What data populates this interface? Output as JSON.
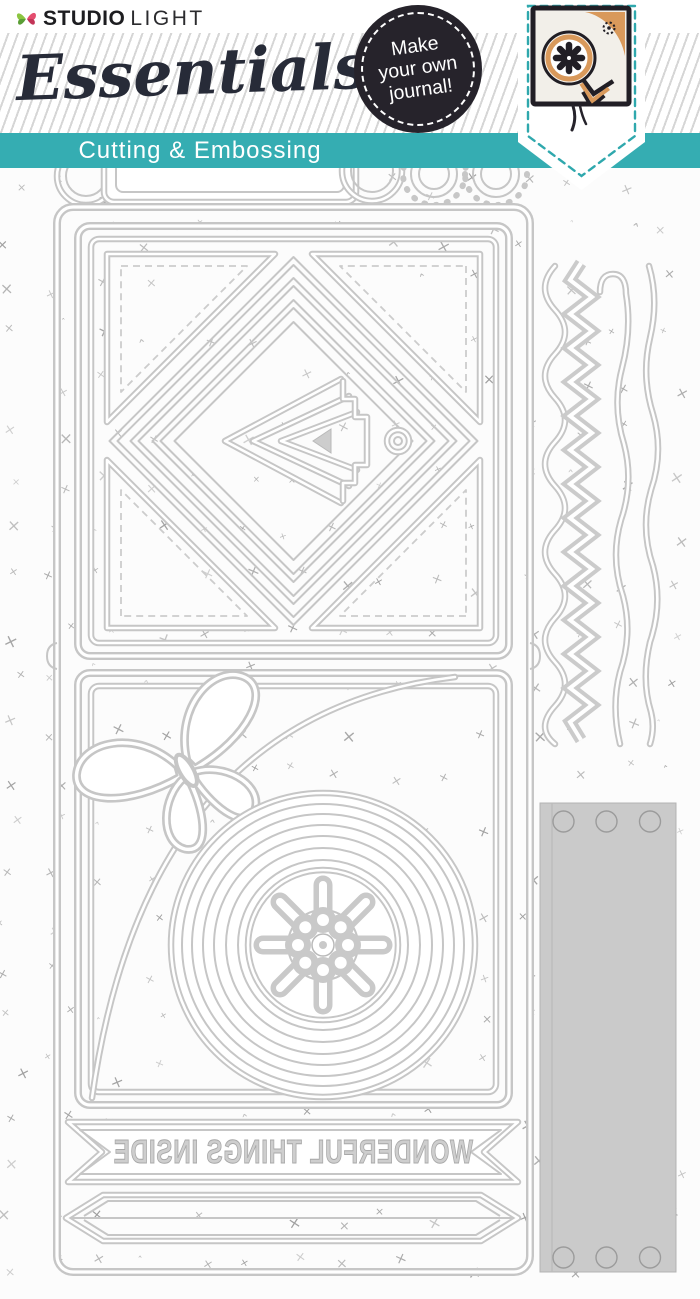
{
  "product": {
    "brand": {
      "word1": "STUDIO",
      "word2": "LIGHT"
    },
    "series_title": "Essentials",
    "subtitle": "Cutting & Embossing",
    "badge_lines": [
      "Make",
      "your own",
      "journal!"
    ],
    "die_cut_text": {
      "banner": "WONDERFUL THINGS INSIDE"
    }
  },
  "colors": {
    "teal": "#35adb2",
    "teal_dash": "#2fa8ad",
    "badge_bg": "#26232b",
    "script_navy": "#272b38",
    "die_gray": "#c6c6c6",
    "die_fill_gray": "#cacaca",
    "pattern_gray": "#8d8d8d",
    "photo_tan": "#d9995b",
    "photo_frame": "#211e25"
  },
  "icons": {
    "logo": "butterfly-icon",
    "badge": "circle-badge",
    "photo_motifs": [
      "gear-icon",
      "chevron-icon",
      "tassel-icon"
    ]
  },
  "pattern": {
    "glyphs": [
      "×",
      "ˆ"
    ],
    "color": "#8d8d8d"
  }
}
